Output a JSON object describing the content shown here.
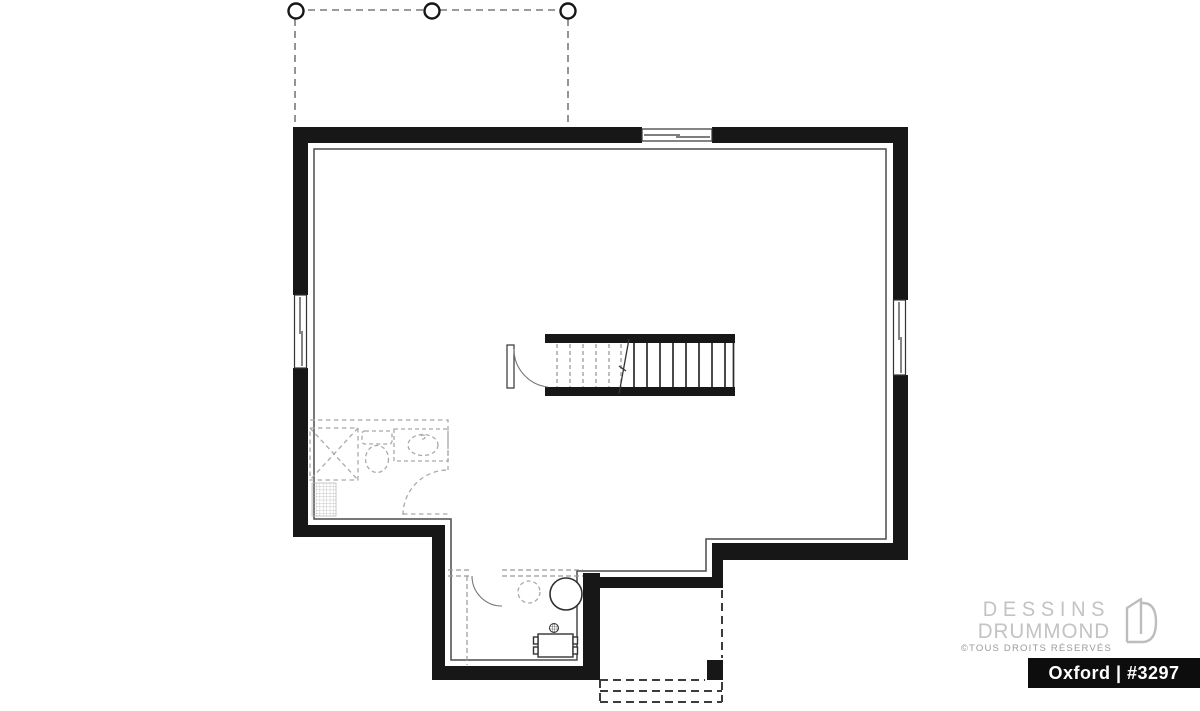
{
  "branding": {
    "logo_line1": "DESSINS",
    "logo_line2": "DRUMMOND",
    "copyright": "©TOUS DROITS RÉSERVÉS",
    "plan_label": "Oxford | #3297",
    "logo_icon": "drummond-door-d-icon",
    "colors": {
      "logo_gray": "#c3c3c3",
      "copyright_gray": "#9a9a9a",
      "band_background": "#0d0d0d",
      "band_text": "#ffffff"
    }
  },
  "floor_plan": {
    "background": "#ffffff",
    "wall_color": "#171717",
    "inner_line_color": "#4a4a4a",
    "fixture_dash_color": "#a9a9a9",
    "deck_dash_color": "#7a7a7a",
    "porch_dash_color": "#3c3c3c",
    "components": [
      "deck-dashed-outline",
      "deck-column-posts",
      "top-wall-window",
      "left-wall-window",
      "right-wall-window",
      "central-staircase",
      "stair-entry-door",
      "stair-direction-line",
      "future-bathroom-outline",
      "corner-shower",
      "toilet",
      "vanity-sink",
      "tiled-floor-area",
      "future-laundry-partition",
      "laundry-door-swing",
      "water-heater",
      "future-round-fixture",
      "floor-drain",
      "washer-appliance",
      "covered-porch-post",
      "porch-steps"
    ]
  }
}
